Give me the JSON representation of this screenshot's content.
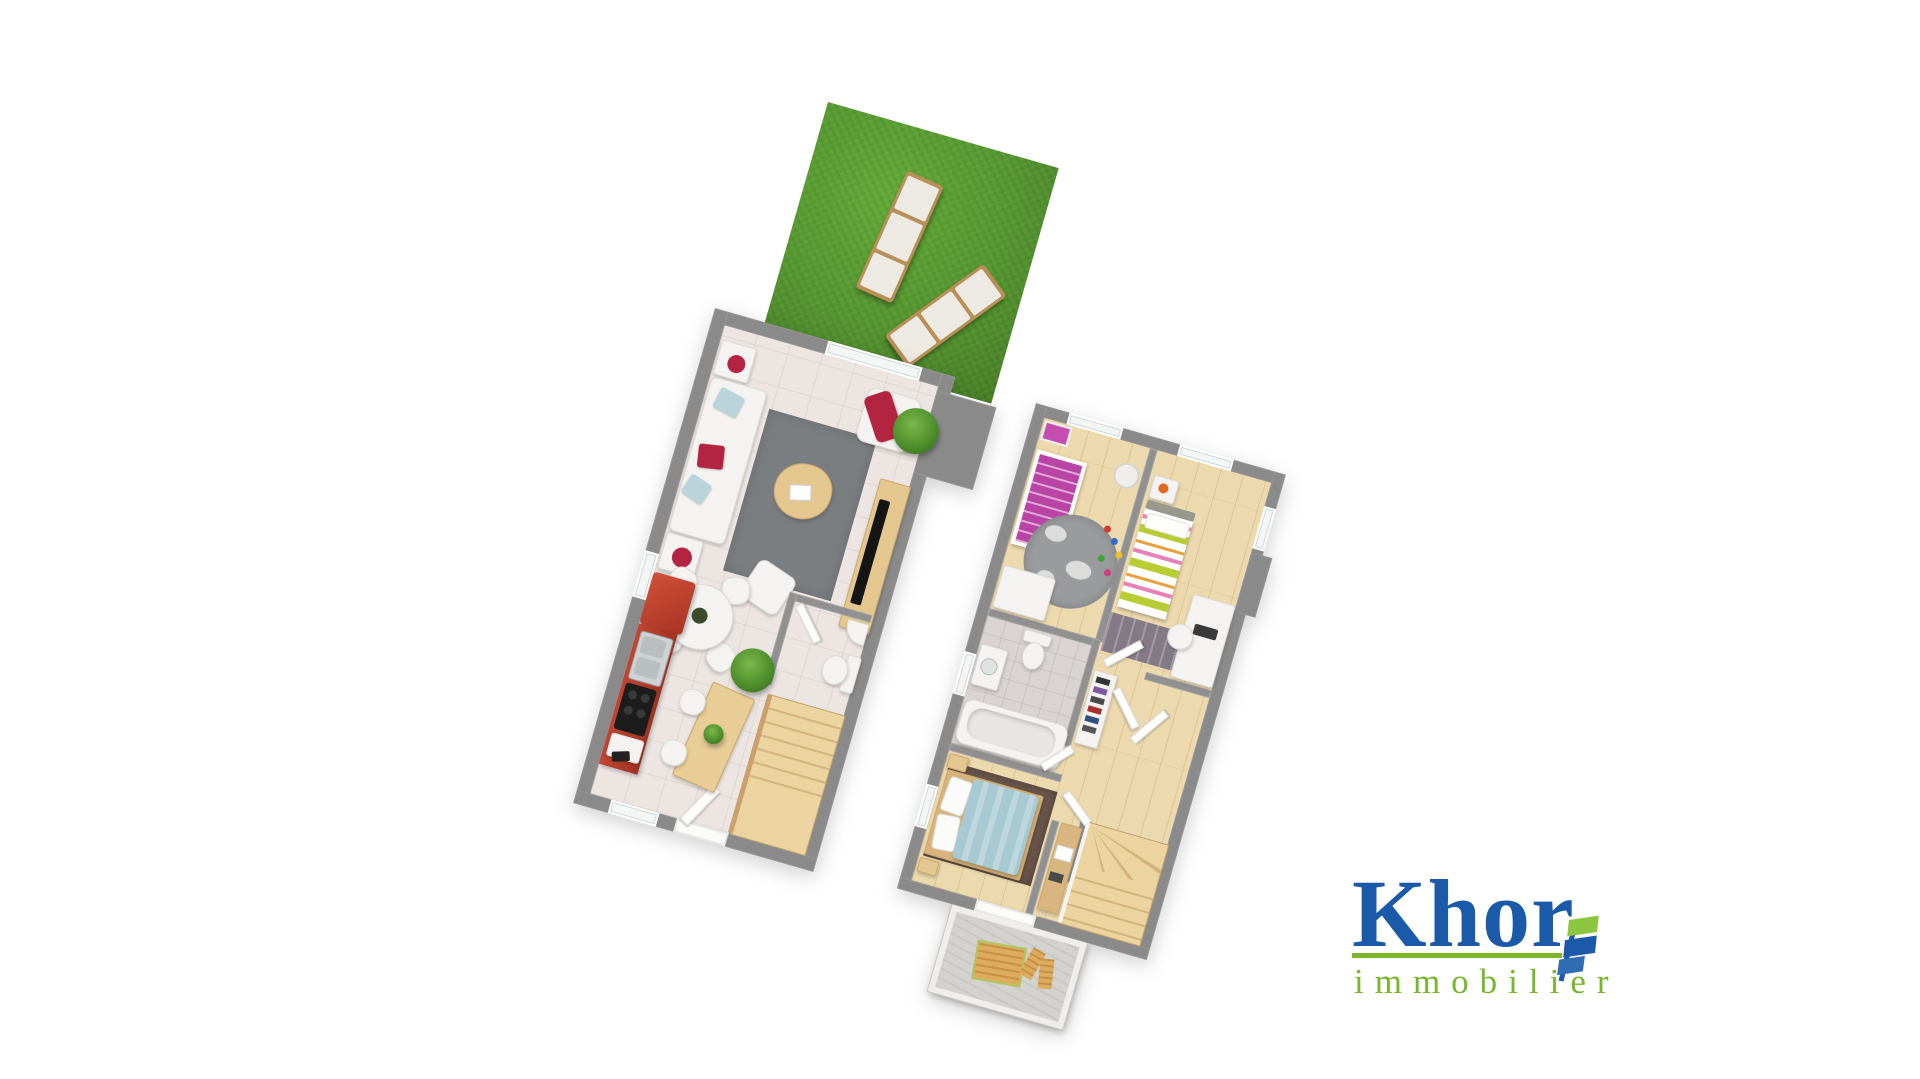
{
  "page": {
    "type": "3d-floor-plan-render",
    "background": "#ffffff"
  },
  "logo": {
    "name": "Khor",
    "tagline": "immobilier",
    "brand_blue": "#1a5aa8",
    "brand_green": "#7db52c",
    "icon": "flag-ribbon"
  },
  "palette": {
    "wall_gray": "#8a8a8a",
    "ground_floor_tile": "#ece5e2",
    "upper_floor_wood": "#ecd9ae",
    "grass_green": "#559730",
    "kitchen_red": "#b8402f",
    "stairs_wood": "#ecd4a0",
    "rug_gray": "#7b7e81",
    "rug_brown": "#6a564b",
    "bed_blue": "#a7c9d2",
    "bed_magenta": "#b944a6",
    "bed_lime": "#b8cc33"
  },
  "garden": {
    "label": "garden-terrace",
    "items": [
      "sun-lounger",
      "sun-lounger"
    ]
  },
  "ground_floor": {
    "label": "ground-floor-plan",
    "rooms": [
      {
        "name": "living-room",
        "furniture": [
          "sofa",
          "coffee-table",
          "rug",
          "pouf",
          "armchair",
          "tv-sideboard",
          "side-tables",
          "plant"
        ]
      },
      {
        "name": "dining-area",
        "furniture": [
          "round-table",
          "chairs"
        ]
      },
      {
        "name": "kitchen",
        "furniture": [
          "fridge",
          "sink",
          "cooktop",
          "island-bar",
          "stools",
          "plant"
        ]
      },
      {
        "name": "wc",
        "furniture": [
          "toilet",
          "corner-basin"
        ]
      },
      {
        "name": "stairs",
        "furniture": [
          "winder-staircase"
        ]
      }
    ]
  },
  "upper_floor": {
    "label": "upper-floor-plan",
    "rooms": [
      {
        "name": "child-bedroom",
        "furniture": [
          "crib",
          "round-rug",
          "wardrobe",
          "toys",
          "floor-lamp"
        ]
      },
      {
        "name": "bedroom-2",
        "furniture": [
          "single-bed",
          "nightstand",
          "desk",
          "chair",
          "rug"
        ]
      },
      {
        "name": "bathroom",
        "furniture": [
          "bathtub",
          "toilet",
          "washbasin"
        ]
      },
      {
        "name": "master-bedroom",
        "furniture": [
          "double-bed",
          "nightstands",
          "rug"
        ]
      },
      {
        "name": "hallway",
        "furniture": [
          "shoe-rack",
          "open-doors",
          "console-desk"
        ]
      },
      {
        "name": "stairs",
        "furniture": [
          "winder-staircase"
        ]
      },
      {
        "name": "balcony",
        "furniture": [
          "wood-table",
          "chairs"
        ]
      }
    ]
  }
}
